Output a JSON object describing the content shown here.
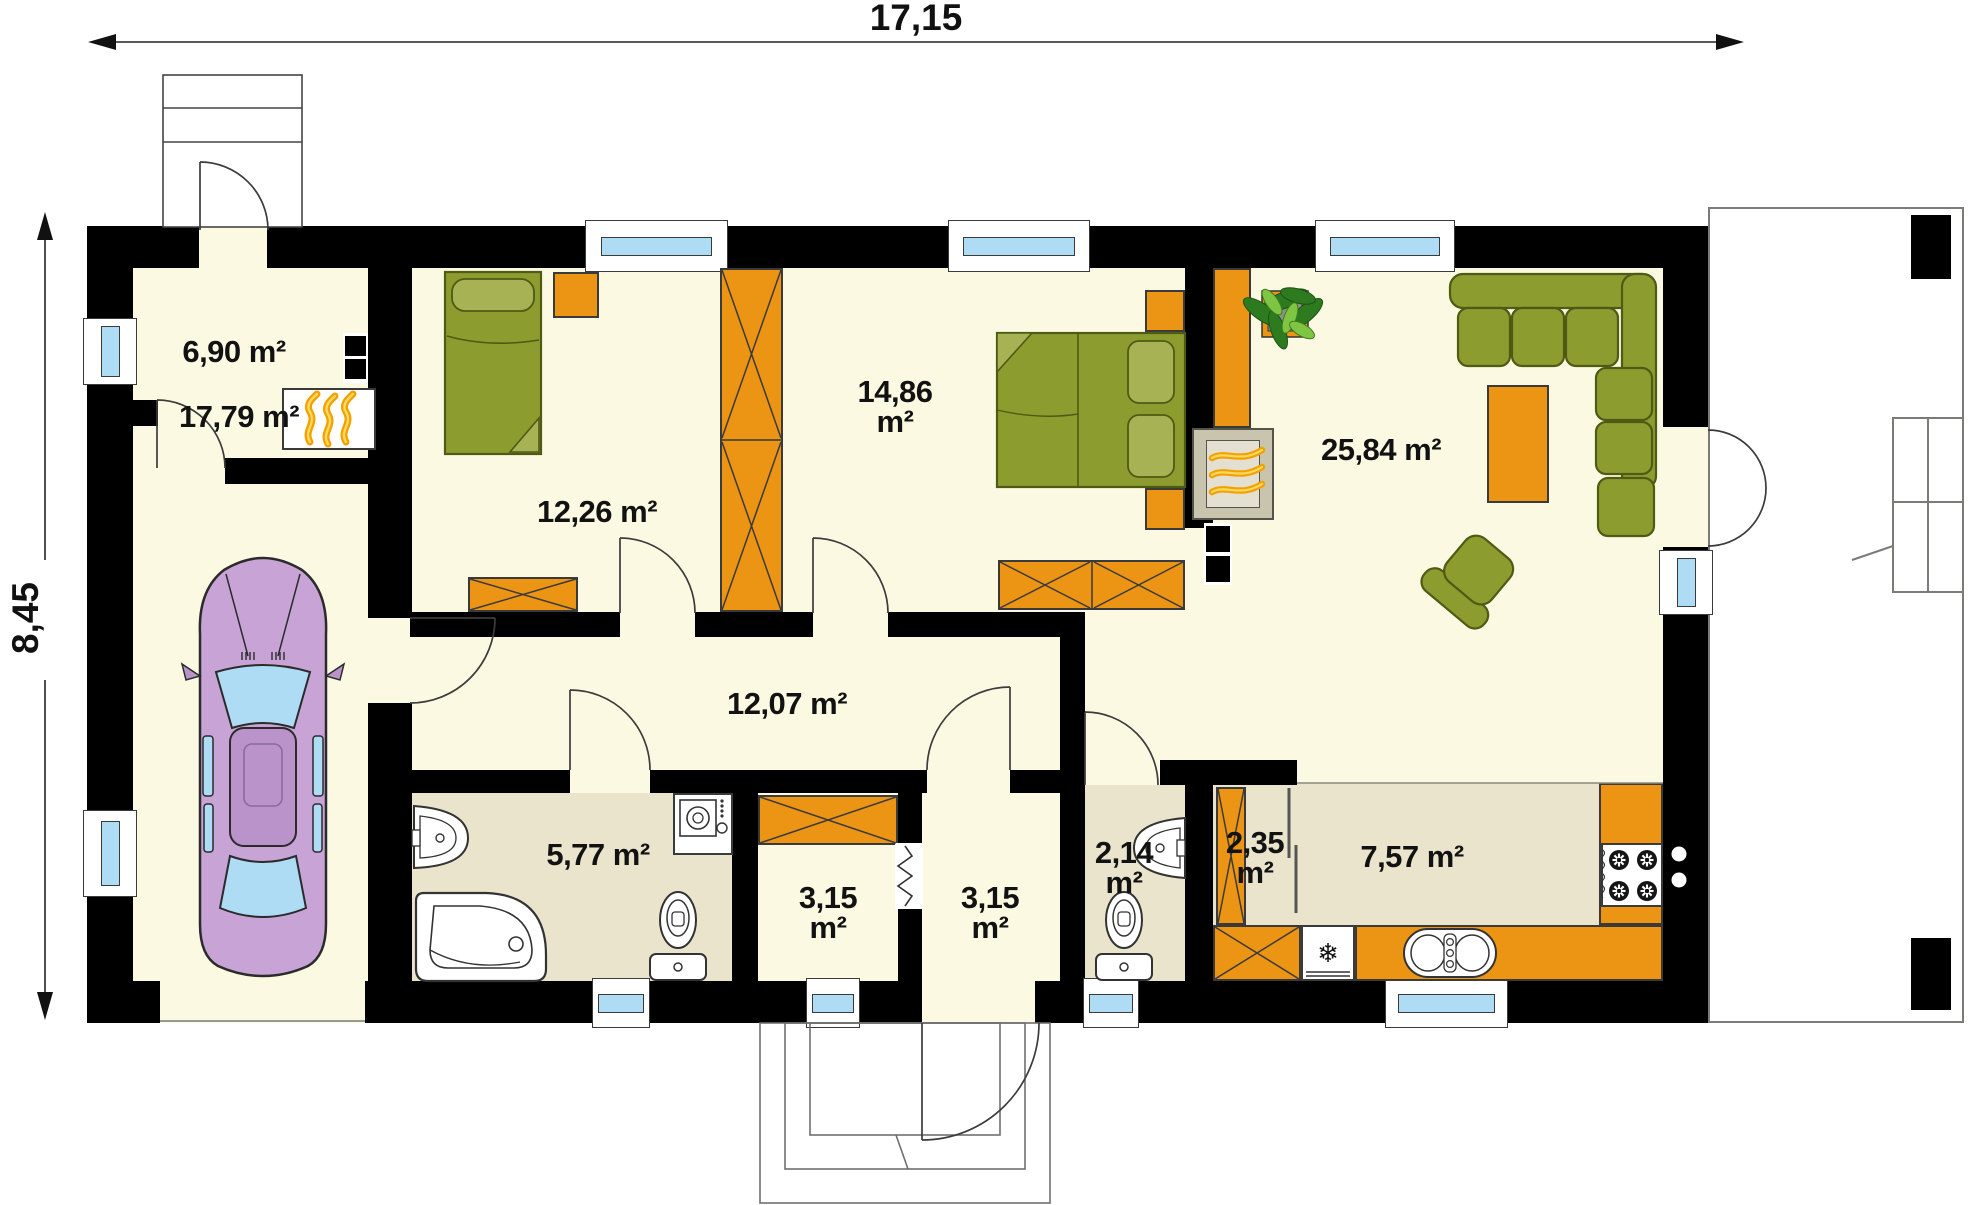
{
  "dimensions": {
    "total_width": "17,15",
    "total_height": "8,45"
  },
  "rooms": {
    "boiler": {
      "label": "6,90 m²"
    },
    "garage": {
      "label": "17,79 m²"
    },
    "bedroom_left": {
      "label": "12,26 m²"
    },
    "bedroom_right": {
      "line1": "14,86",
      "line2": "m²"
    },
    "living_room": {
      "label": "25,84 m²"
    },
    "hall": {
      "label": "12,07 m²"
    },
    "bathroom": {
      "label": "5,77 m²"
    },
    "wardrobe_room": {
      "line1": "3,15",
      "line2": "m²"
    },
    "vestibule": {
      "line1": "3,15",
      "line2": "m²"
    },
    "wc": {
      "line1": "2,14",
      "line2": "m²"
    },
    "pantry": {
      "line1": "2,35",
      "line2": "m²"
    },
    "kitchen": {
      "label": "7,57 m²"
    }
  },
  "colors": {
    "wall": "#000000",
    "floor_cream": "#fcf9e3",
    "floor_beige": "#e9e4cb",
    "accent_orange": "#ec9414",
    "furniture_green": "#8d9c2f",
    "furniture_green_dark": "#4f5a14",
    "green_light": "#a7b254",
    "window_glass": "#aedcf4",
    "car_body": "#c7a3d6",
    "car_roof": "#b993c9",
    "flame_orange": "#f2a200",
    "flame_yellow": "#ffd95e",
    "fireplace_grey": "#c9c4ae"
  }
}
